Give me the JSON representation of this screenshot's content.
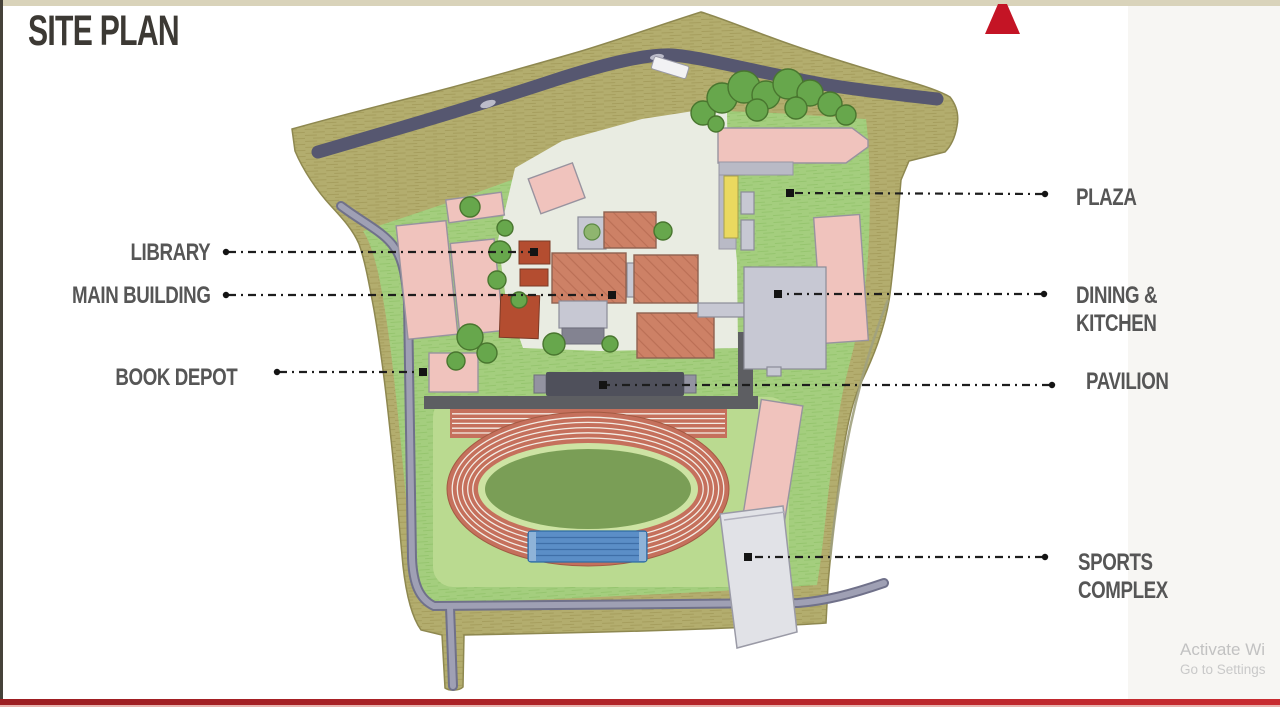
{
  "slide": {
    "title": "SITE PLAN",
    "watermark_line1": "Activate Wi",
    "watermark_line2": "Go to Settings"
  },
  "labels": {
    "library": "LIBRARY",
    "main_building": "MAIN BUILDING",
    "book_depot": "BOOK DEPOT",
    "plaza": "PLAZA",
    "dining_line1": "DINING &",
    "dining_line2": "KITCHEN",
    "pavilion": "PAVILION",
    "sports_line1": "SPORTS",
    "sports_line2": "COMPLEX"
  },
  "colors": {
    "accent_red": "#c41425",
    "slide_top_strip": "#d9d3ba",
    "title": "#3c3934",
    "label": "#565656",
    "leader": "#1d1d1d",
    "khaki": "#b3ad6e",
    "lawn": "#a4ce7e",
    "track_zone": "#bada90",
    "paving": "#e9ece2",
    "road_dark": "#565770",
    "road_mid": "#70718a",
    "road_light": "#9fa0b4",
    "building_pink": "#f0c3bd",
    "building_terracotta": "#cd8166",
    "building_red": "#b44d30",
    "building_gray": "#c7c8d3",
    "building_yellow": "#ead95f",
    "building_dark": "#4f505b",
    "track": "#c5705c",
    "infield": "#7a9e56",
    "apron": "#cde3a3",
    "pool": "#5b8ec7",
    "sports_white": "#e1e2e7",
    "tree": "#67a74c",
    "tree_edge": "#49762f",
    "watermark": "#c2c2c2",
    "bottom_bar_left": "#9c1e22",
    "bottom_bar_right": "#c82b30"
  },
  "map_features": [
    "site-boundary",
    "perimeter-landscape",
    "main-access-road",
    "shuttle-bus",
    "campus-lawn",
    "central-courtyard-paving",
    "west-internal-road",
    "south-internal-road",
    "road-stub",
    "library-buildings",
    "main-building-complex",
    "book-depot-building",
    "plaza-building",
    "dining-kitchen-building",
    "pavilion-building",
    "covered-walkway",
    "dormitory-blocks",
    "running-track",
    "track-infield",
    "swimming-pool",
    "sprint-straight",
    "sports-complex-building",
    "grandstand-building",
    "tree-cluster",
    "trees",
    "north-arrow"
  ]
}
